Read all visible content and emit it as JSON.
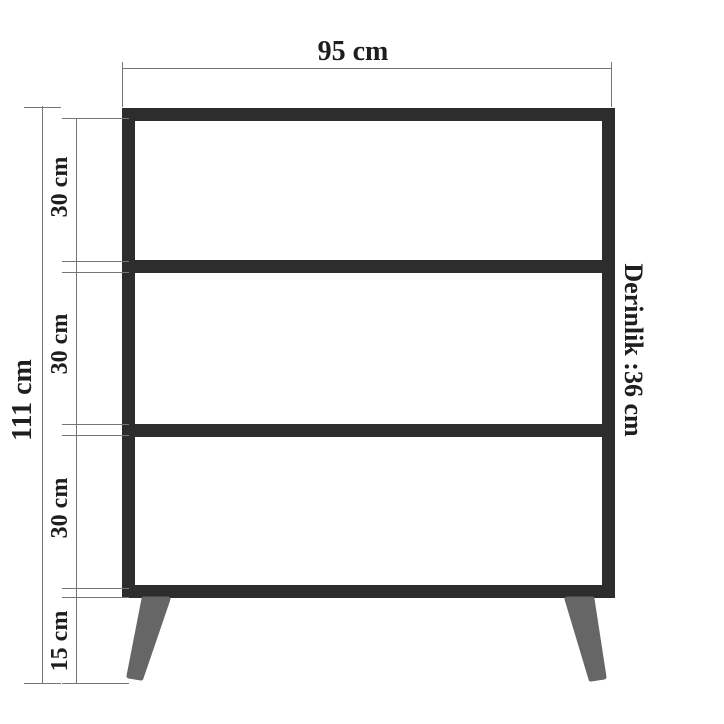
{
  "diagram": {
    "type": "furniture-dimension-drawing",
    "top_dimension": {
      "label": "95 cm"
    },
    "left_outer_dimension": {
      "label": "111 cm"
    },
    "left_inner_dimensions": [
      {
        "label": "30 cm"
      },
      {
        "label": "30 cm"
      },
      {
        "label": "30 cm"
      },
      {
        "label": "15 cm"
      }
    ],
    "right_dimension": {
      "label": "Derinlik :36 cm"
    },
    "colors": {
      "frame": "#2d2d2d",
      "legs": "#666666",
      "dimension_lines": "#757575",
      "text": "#1e1e1e",
      "background": "#ffffff"
    }
  }
}
